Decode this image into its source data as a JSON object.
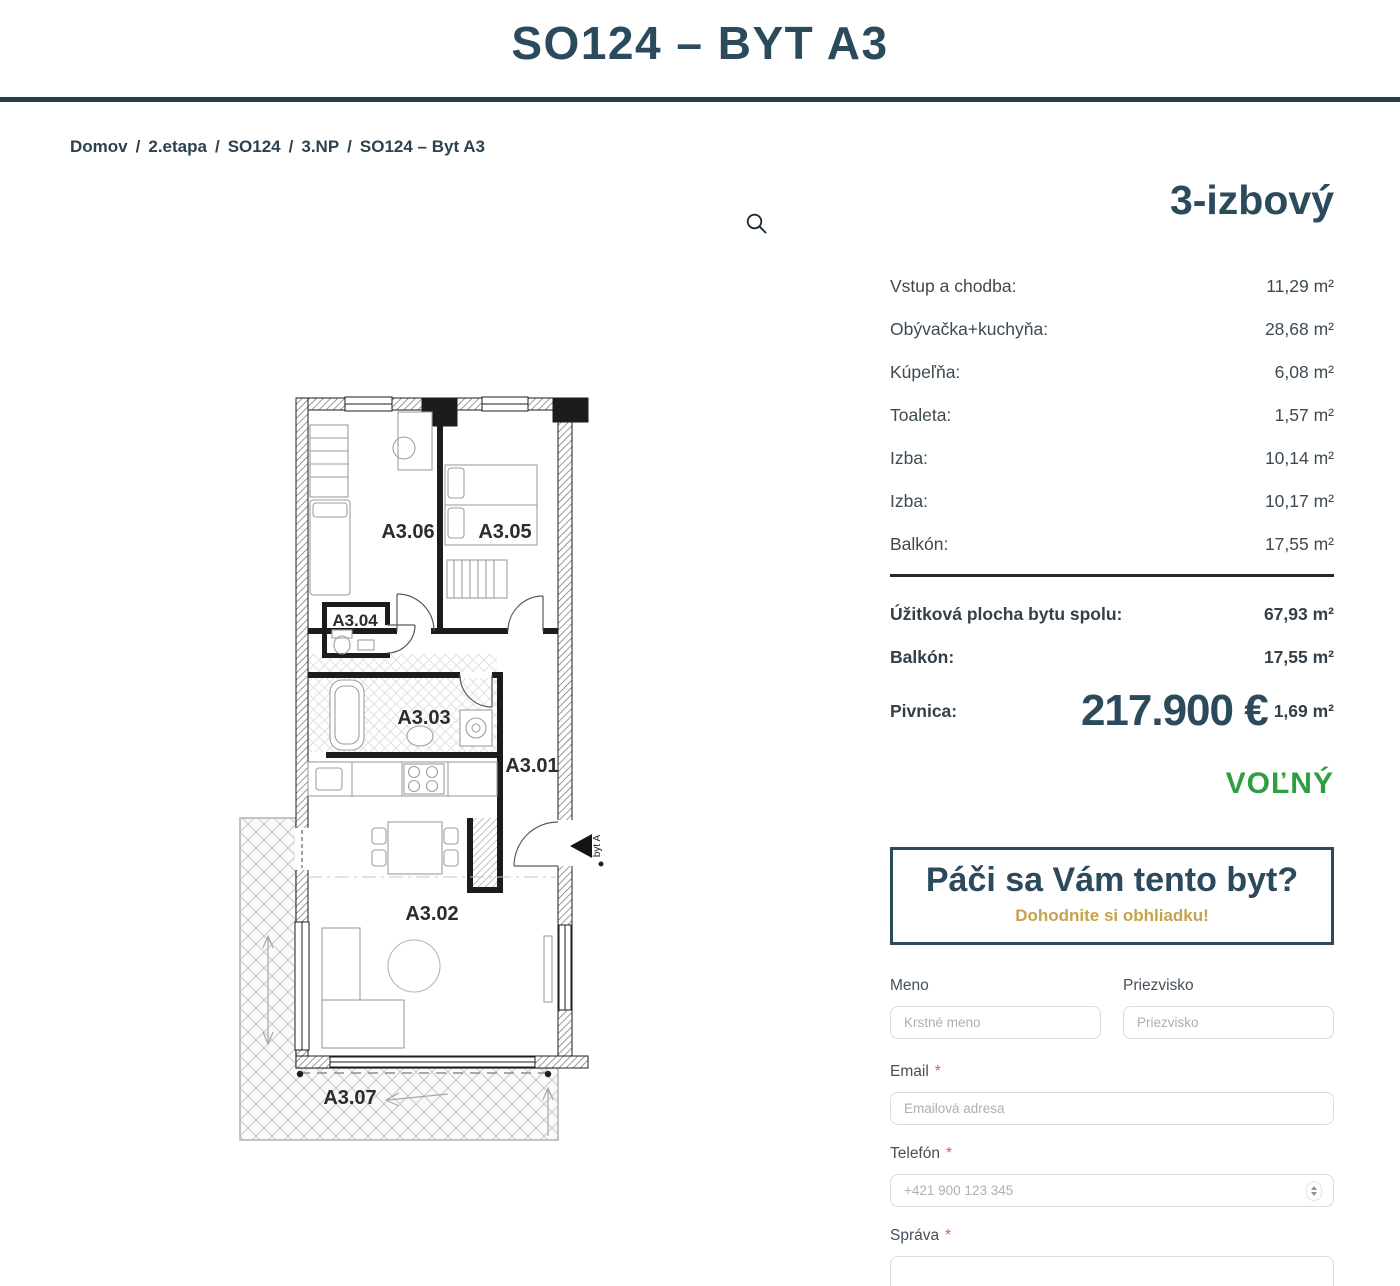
{
  "header": {
    "title": "SO124 – BYT A3"
  },
  "breadcrumb": {
    "separator": "/",
    "items": [
      "Domov",
      "2.etapa",
      "SO124",
      "3.NP"
    ],
    "current": "SO124 – Byt A3"
  },
  "summary": {
    "type": "3-izbový",
    "rooms": [
      {
        "label": "Vstup a chodba:",
        "value": "11,29 m²"
      },
      {
        "label": "Obývačka+kuchyňa:",
        "value": "28,68 m²"
      },
      {
        "label": "Kúpeľňa:",
        "value": "6,08 m²"
      },
      {
        "label": "Toaleta:",
        "value": "1,57 m²"
      },
      {
        "label": "Izba:",
        "value": "10,14 m²"
      },
      {
        "label": "Izba:",
        "value": "10,17 m²"
      },
      {
        "label": "Balkón:",
        "value": "17,55 m²"
      }
    ],
    "totals": [
      {
        "label": "Úžitková plocha bytu spolu:",
        "value": "67,93 m²"
      },
      {
        "label": "Balkón:",
        "value": "17,55 m²"
      },
      {
        "label": "Pivnica:",
        "value": "1,69 m²"
      }
    ],
    "price": "217.900 €",
    "status": "VOĽNÝ"
  },
  "cta": {
    "title": "Páči sa Vám tento byt?",
    "subtitle": "Dohodnite si obhliadku!"
  },
  "form": {
    "required_mark": "*",
    "meno": {
      "label": "Meno",
      "placeholder": "Krstné meno"
    },
    "priezvisko": {
      "label": "Priezvisko",
      "placeholder": "Priezvisko"
    },
    "email": {
      "label": "Email",
      "placeholder": "Emailová adresa"
    },
    "telefon": {
      "label": "Telefón",
      "placeholder": "+421 900 123 345"
    },
    "sprava": {
      "label": "Správa"
    }
  },
  "floorplan": {
    "rooms": [
      "A3.06",
      "A3.05",
      "A3.04",
      "A3.03",
      "A3.01",
      "A3.02",
      "A3.07"
    ],
    "entrance_label": "byt A"
  },
  "colors": {
    "accent": "#2b4a5c",
    "status_green": "#2f9e41",
    "cta_gold": "#c7a24e",
    "required_red": "#e2574c"
  }
}
